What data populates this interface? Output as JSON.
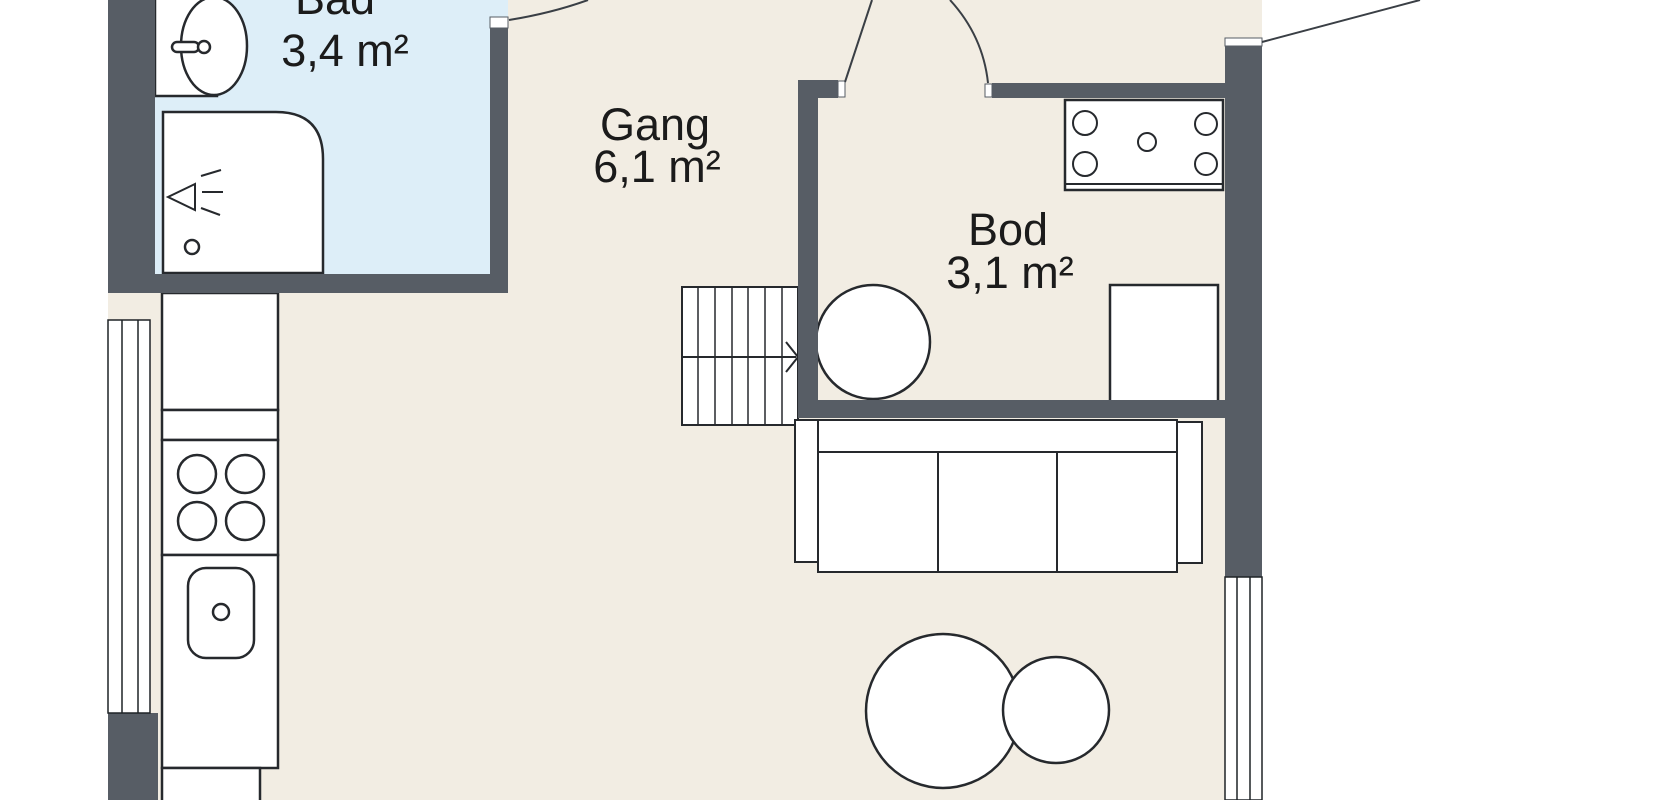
{
  "plan_title": "Floor plan",
  "rooms": {
    "bad": {
      "label": "Bad",
      "area": "3,4 m²"
    },
    "gang": {
      "label": "Gang",
      "area": "6,1 m²"
    },
    "bod": {
      "label": "Bod",
      "area": "3,1 m²"
    }
  },
  "colors": {
    "wall": "#575d65",
    "floor": "#f2ede3",
    "bathroom_floor": "#ddeef8",
    "outline": "#26292d",
    "background": "#ffffff"
  }
}
